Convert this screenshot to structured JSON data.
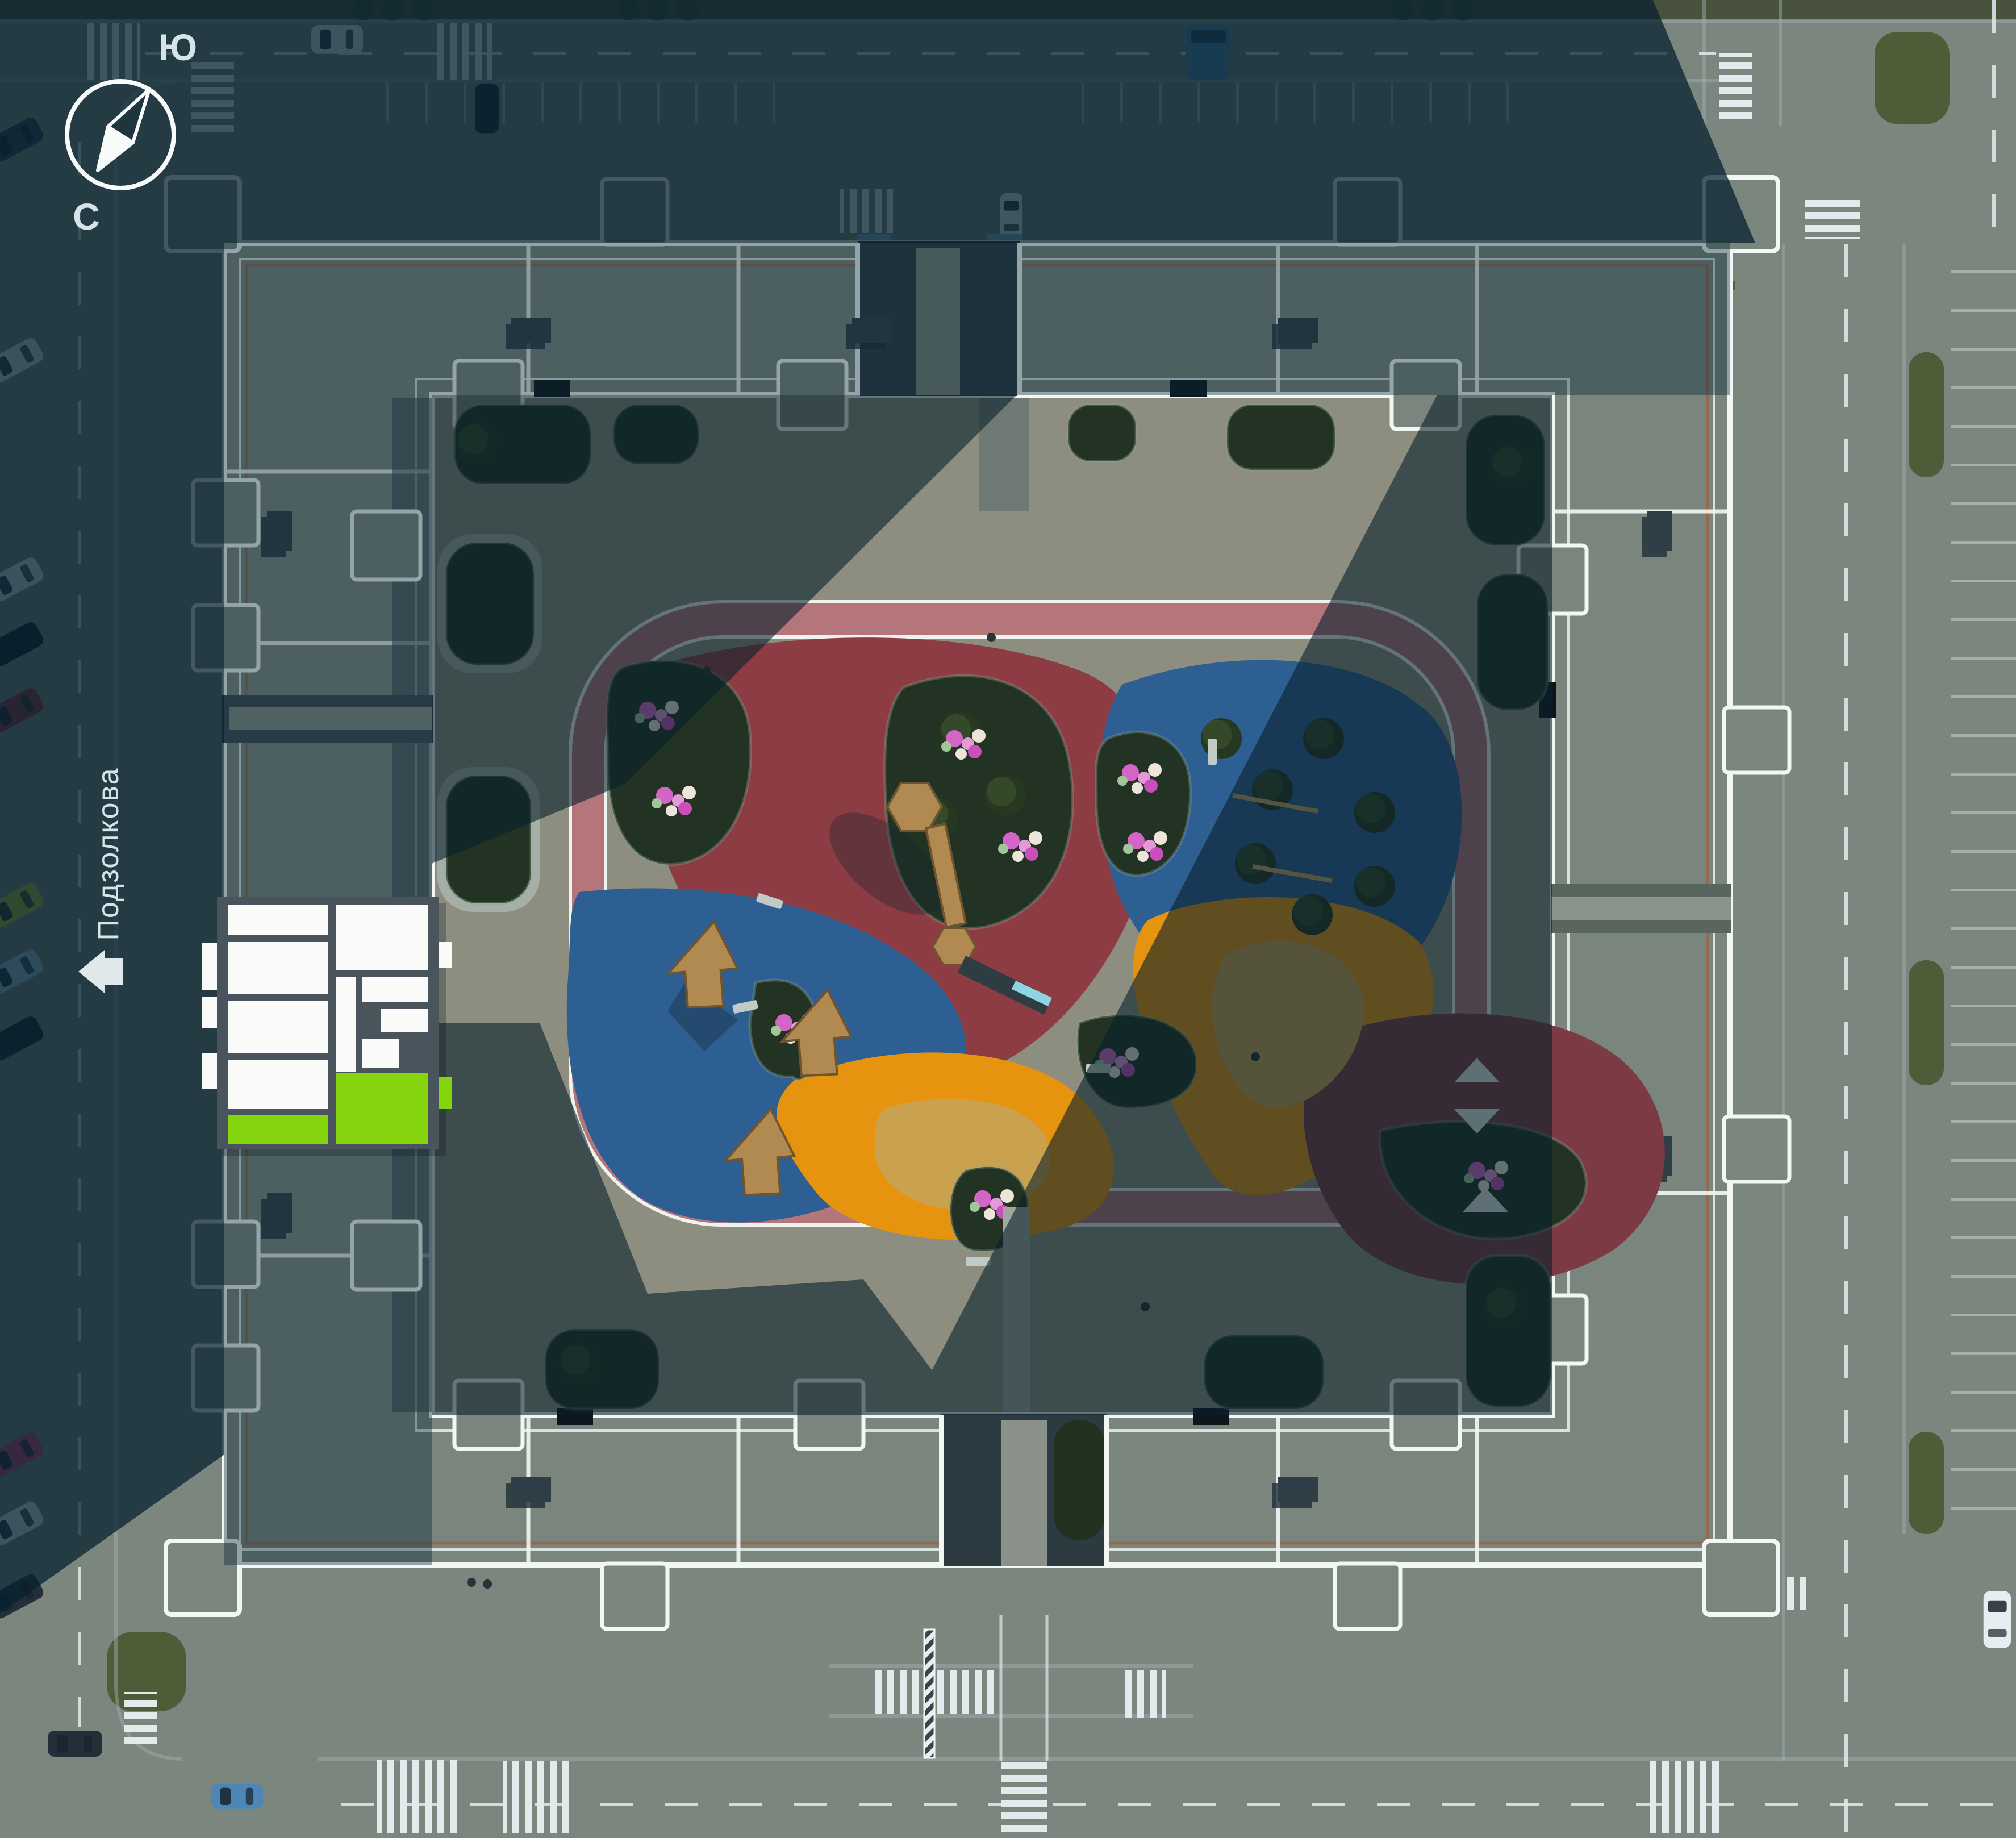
{
  "compass": {
    "south_label": "Ю",
    "north_label": "С"
  },
  "street": {
    "name": "Подзолкова",
    "icon": "house-arrow-left"
  },
  "palette": {
    "pavement": "#7b867f",
    "courtyard": "#8d8e80",
    "roof": "#7a857e",
    "parapet": "#f2f7f4",
    "parapet_accent": "#9b6242",
    "track": "#b5767b",
    "track_line": "#eef3f0",
    "shadow_street": "#06202e",
    "shadow_roof": "#0a2736",
    "shadow_courtyard": "#081f2c"
  },
  "playgrounds": {
    "red": "#8e3c44",
    "blue": "#2e5f93",
    "orange": "#e6930f",
    "maroon": "#7c3a44",
    "sand": "#c9a14f"
  },
  "floor_plan": {
    "wall_color": "#4a545c",
    "room_color": "#fafaf8",
    "highlight_color": "#84d40e"
  }
}
